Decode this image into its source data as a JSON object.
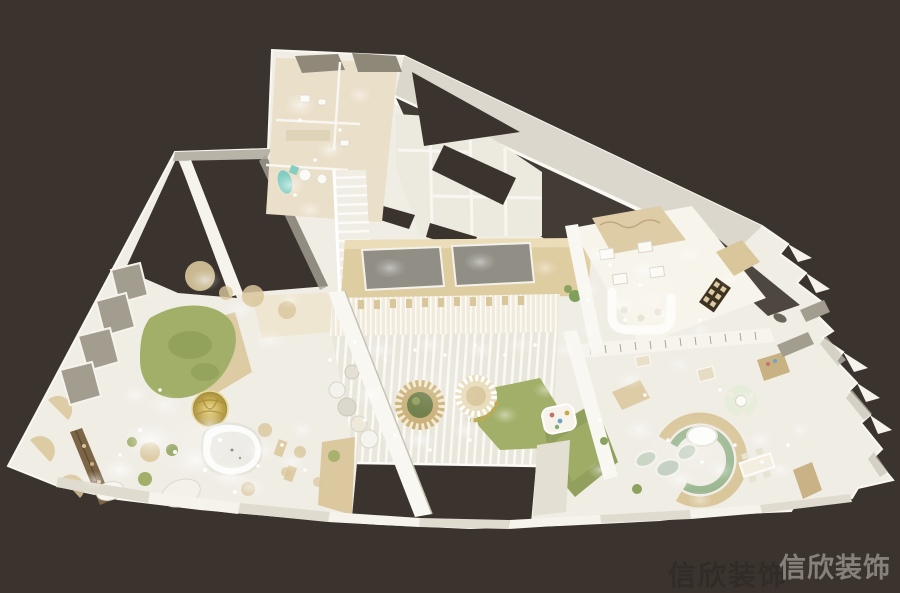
{
  "watermark": {
    "primary": "信欣装饰",
    "shadow": "信欣装饰"
  },
  "palette": {
    "background": "#3B342E",
    "floor": "#F0EDE5",
    "wall": "#F9F7F1",
    "wall_shadow": "#C7C2B6",
    "panel_gray": "#DAD6CA",
    "olive": "#A29D8F",
    "beige": "#EADFC9",
    "tan": "#D9C69B",
    "gold": "#C6A94E",
    "green": "#A2AF68",
    "green_dark": "#8C9C56",
    "sage": "#9CB892",
    "teal": "#82CEC2",
    "mat_gray": "#908E85",
    "wood": "#7C6547",
    "glow": "#FFFFFF",
    "watermark_light": "#8D8882",
    "watermark_dark": "#312C27"
  }
}
